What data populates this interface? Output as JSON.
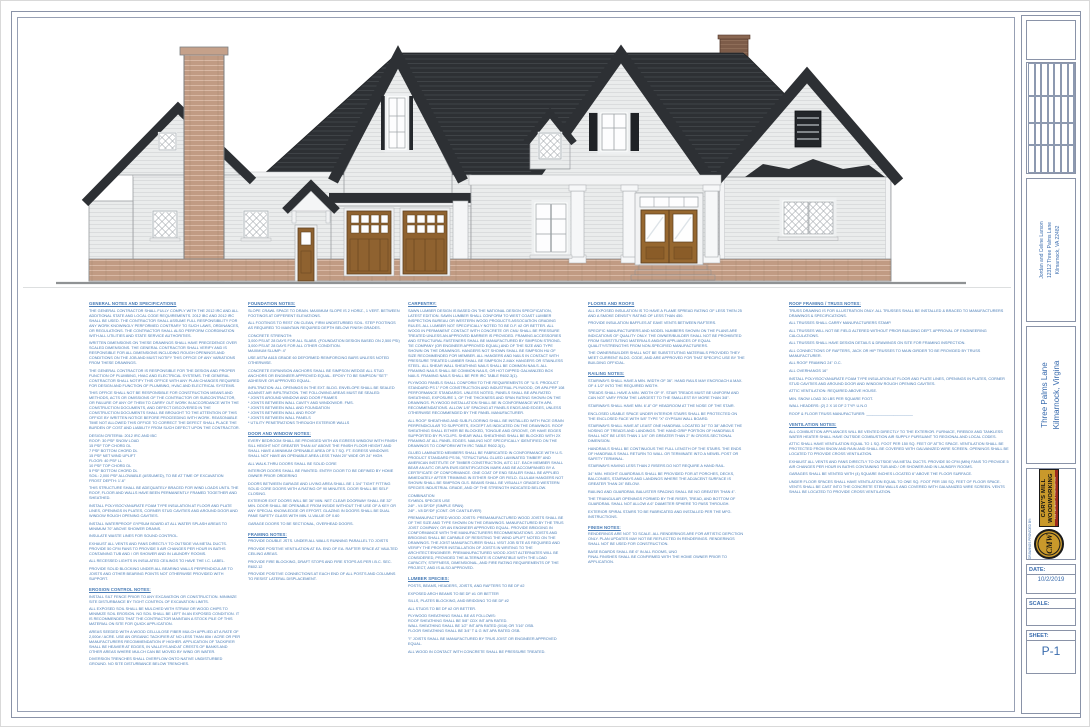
{
  "palette": {
    "note_text_blue": "#4579b4",
    "titleblock_blue": "#3a6cae",
    "roof_charcoal": "#2d3034",
    "siding_gray": "#eaecec",
    "brick_tan": "#c19b83",
    "door_wood_brown": "#8f6230",
    "logo_gold": "#c9992b",
    "logo_red": "#9e2b1e"
  },
  "titleblock": {
    "revision_table": {
      "title": "REVISION TABLE",
      "columns": [
        "NUMBER",
        "DATE",
        "REVISED BY",
        "DESCRIPTION"
      ],
      "empty_rows": 7
    },
    "owner_lines": [
      "Jordan and Celine Larson",
      "12312 Three Palms Lane",
      "Kilmarnock, VA 22482"
    ],
    "project_lines": [
      "Three Palms Lane",
      "Kilmarnock, Virgina"
    ],
    "provider_label": "DRAWINGS PROVIDED BY:",
    "logo": {
      "monogram": "CMW",
      "line1": "CARY'S MILL",
      "line2": "WOODWORKING",
      "tagline": "FINE CABINETRY & CONSTRUCTION"
    },
    "date_label": "DATE:",
    "date_value": "10/2/2019",
    "scale_label": "SCALE:",
    "scale_value": "",
    "sheet_label": "SHEET:",
    "sheet_value": "P-1"
  },
  "notes": {
    "columns": [
      {
        "sections": [
          {
            "heading": "GENERAL NOTES AND SPECIFICATIONS",
            "paragraphs": [
              "THE GENERAL CONTRACTOR SHALL FULLY COMPLY WITH THE 2012 IRC AND ALL ADDITIONAL STATE AND LOCAL CODE REQUIREMENTS. 2012 IBC AND 2012 IRC SHALL BE USED. THE CONTRACTOR SHALL ASSUME FULL RESPONSIBILITY FOR ANY WORK KNOWINGLY PERFORMED CONTRARY TO SUCH LAWS, ORDINANCES, OR REGULATIONS. THE CONTRACTOR SHALL ALSO PERFORM COORDINATION WITH ALL UTILITIES AND STATE SERVICE AUTHORITIES.",
              "WRITTEN DIMENSIONS ON THESE DRAWINGS SHALL HAVE PRECEDENCE OVER SCALED DIMENSIONS. THE GENERAL CONTRACTOR SHALL VERIFY AND IS RESPONSIBLE FOR ALL DIMENSIONS INCLUDING ROUGH OPENINGS AND CONDITIONS ON THE JOB AND MUST NOTIFY THIS OFFICE OF ANY VARIATIONS FROM THESE DRAWINGS.",
              "THE GENERAL CONTRACTOR IS RESPONSIBLE FOR THE DESIGN AND PROPER FUNCTION OF PLUMBING, HVAC AND ELECTRICAL SYSTEMS. THE GENERAL CONTRACTOR SHALL NOTIFY THIS OFFICE WITH ANY PLAN CHANGES REQUIRED FOR DESIGN AND FUNCTION OF PLUMBING, HVAC AND ELECTRICAL SYSTEMS.",
              "THIS OFFICE SHALL NOT BE RESPONSIBLE FOR CONSTRUCTION MEANS AND METHODS, ACTS OR OMISSIONS OF THE CONTRACTOR OR SUBCONTRACTOR, OR FAILURE OF ANY OF THEM TO CARRY OUT WORK IN ACCORDANCE WITH THE CONSTRUCTION DOCUMENTS, AND DEFECT DISCOVERED IN THE CONSTRUCTION DOCUMENTS SHALL BE BROUGHT TO THE ATTENTION OF THIS OFFICE BY WRITTEN NOTICE BEFORE PROCEEDING WITH WORK. REASONABLE TIME NOT ALLOWED THIS OFFICE TO CORRECT THE DEFECT SHALL PLACE THE BURDEN OF COST AND LIABILITY FROM SUCH DEFECT UPON THE CONTRACTOR.",
              "DESIGN CRITERIA:   2012 IRC AND IBC\nROOF:      30 PSF SNOW LOAD\n           15 PSF TOP CHORD DL\n           7 PSF BOTTOM CHORD DL\n           15 PSF NET WIND UPLIFT\nFLOOR:   40 PSF LL\n           10 PSF TOP CHORD DL\n           5 PSF BOTTOM CHORD DL\nSOIL:      2,000 PSF ALLOWABLE (ASSUMED), TO BE AT TIME OF EXCAVATION\nFROST DEPTH:  1'-6\"",
              "THIS STRUCTURE SHALL BE ADEQUATELY BRACED FOR WIND LOADS UNTIL THE ROOF, FLOOR AND WALLS HAVE BEEN PERMANENTLY FRAMED TOGETHER AND SHEATHED.",
              "INSTALL POLYISOCYANURATE FOAM TYPE INSULATION AT FLOOR AND PLATE LINES, OPENINGS IN PLATES, CORNER STUD CAVITIES AND AROUND DOOR AND WINDOW ROUGH OPENING CAVITIES.",
              "INSTALL WATERPROOF GYPSUM BOARD AT ALL WATER SPLASH AREAS TO MINIMUM 70\" ABOVE SHOWER DRAINS.",
              "INSULATE WASTE LINES FOR SOUND CONTROL.",
              "EXHAUST ALL VENTS AND FANS DIRECTLY TO OUTSIDE VIA METAL DUCTS. PROVIDE 50 CFM FANS TO PROVIDE 5 AIR CHANGES PER HOUR IN BATHS CONTAINING TUB AND / OR SHOWER AND IN LAUNDRY ROOMS.",
              "ALL RECESSED LIGHTS IN INSULATED CEILINGS TO HAVE THE I.C. LABEL.",
              "PROVIDE SOLID BLOCKING UNDER ALL BEARING WALLS PERPENDICULAR TO JOISTS AND OTHER BEARING POINTS NOT OTHERWISE PROVIDED WITH SUPPORT."
            ]
          },
          {
            "heading": "EROSION CONTROL NOTES:",
            "paragraphs": [
              "INSTALL SILT FENCE PRIOR TO ANY EXCAVATION OR CONSTRUCTION. MINIMIZE SITE DISTURBANCE BY TIGHT CONTROL OF EXCAVATION LIMITS.",
              "ALL EXPOSED SOIL SHALL BE MULCHED WITH STRAW OR WOOD CHIPS TO MINIMIZE SOIL EROSION. NO SOIL SHALL BE LEFT IN AN EXPOSED CONDITION. IT IS RECOMMENDED THAT THE CONTRACTOR MAINTAIN A STOCK PILE OF THIS MATERIAL ON SITE FOR QUICK APPLICATION.",
              "AREAS SEEDED WITH A WOOD CELLULOSE FIBER MULCH APPLIED AT A RATE OF 2,000# / ACRE. USE AN ORGANIC TACKIFIER AT NO LESS THAN 80# / ACRE OR PER MANUFACTURERS RECOMMENDATION IF HIGHER. APPLICATION OF TACKIFIER SHALL BE HEAVIER AT EDGES, IN VALLEYS AND AT CRESTS OF BANKS AND OTHER AREAS WHERE MULCH CAN BE MOVED BY WIND OR WATER.",
              "DIVERSION TRENCHES SHALL OVERFLOW ONTO NATIVE UNDISTURBED GROUND. NO SITE DISTURBANCE BELOW TRENCHES."
            ]
          }
        ]
      },
      {
        "sections": [
          {
            "heading": "FOUNDATION NOTES:",
            "paragraphs": [
              "SLOPE CRAWL SPACE TO DRAIN. MAXIMUM SLOPE IS 2 HORIZ., 1 VERT. BETWEEN FOOTINGS AT DIFFERENT ELEVATIONS.",
              "ALL FOOTINGS TO REST ON CLEAN, FIRM UNDISTURBED SOIL. STEP FOOTINGS AS REQUIRED TO MAINTAIN REQUIRED DEPTH BELOW FINISH GRADES.",
              "CONCRETE STRENGTH:\n3,000 PSI AT 28 DAYS FOR ALL SLABS. (FOUNDATION DESIGN BASED ON 2,500 PSI)\n3,000 PSI AT 28 DAYS FOR ALL OTHER CONDITION.\nMAXIMUM SLUMP: 4\"",
              "USE ASTM A615 GRADE 60 DEFORMED REINFORCING BARS UNLESS NOTED OTHERWISE.",
              "CONCRETE EXPANSION ANCHORS SHALL BE SIMPSON WEDGE ALL STUD ANCHORS OR ENGINEER APPROVED EQUAL. EPOXY TO BE SIMPSON \"SET\" ADHESIVE OR APPROVED EQUAL.",
              "INFILTRATION: ALL OPENINGS IN THE EXT. BLDG. ENVELOPE SHALL BE SEALED AGAINST AIR INFILTRATION. THE FOLLOWING AREAS MUST BE SEALED:\n* JOINTS AROUND WINDOW AND DOOR FRAMES\n* JOINTS BETWEEN WALL CAVITY AND WINDOW/DR. FMS.\n* JOINTS BETWEEN WALL AND FOUNDATION\n* JOINTS BETWEEN WALL AND ROOF\n* JOINTS BETWEEN WALL PANELS\n* UTILITY PENETRATIONS THROUGH EXTERIOR WALLS"
            ]
          },
          {
            "heading": "DOOR AND WINDOW NOTES:",
            "paragraphs": [
              "EVERY BEDROOM SHALL BE PROVIDED WITH AN EGRESS WINDOW WITH FINISH SILL HEIGHT NOT GREATER THAN 44\" ABOVE THE FINISH FLOOR HEIGHT AND SHALL HAVE A MINIMUM OPENABLE AREA OF 5.7 SQ. FT. EGRESS WINDOWS SHALL NOT HAVE AN OPENABLE AREA LESS THAN 20\" WIDE OR 24\" HIGH.",
              "ALL WALK-THRU DOORS SHALL BE SOLID CORE",
              "INTERIOR DOORS SHALL BE PAINTED.  ENTRY DOOR TO BE DEFINED BY HOME OWNER PRIOR ORDERING",
              "DOORS BETWEEN GARAGE AND LIVING AREA SHALL BE 1 3/4\" TIGHT FITTING SOLID CORE DOORS WITH A RATING OF 90 MINUTES. DOOR SHALL BE SELF CLOSING.",
              "EXTERIOR EXIT DOORS WILL BE 36\" MIN. NET CLEAR DOORWAY SHALL BE 32\" MIN. DOOR SHALL BE OPENABLE FROM INSIDE WITHOUT THE USE OF A KEY OR ANY SPECIAL KNOWLEDGE OR EFFORT. GLAZING IN DOORS SHALL BE DUAL PANE SAFETY GLASS WITH MIN. U-VALUE OF 0.60",
              "GARAGE DOORS TO BE SECTIONAL, OVERHEAD DOORS."
            ]
          },
          {
            "heading": "FRAMING NOTES:",
            "paragraphs": [
              "PROVIDE DOUBLE JSTS. UNDER ALL WALLS RUNNING PARALLEL TO JOISTS",
              "PROVIDE POSITIVE VENTILATION AT EA. END OF EA. RAFTER SPACE AT VAULTED CEILING AREAS.",
              "PROVIDE FIRE BLOCKING, DRAFT STOPS AND FIRE STOPS AS PER I.B.C. SEC. R602.12",
              "PROVIDE POSITIVE CONNECTIONS AT EACH END OF ALL POSTS AND COLUMNS TO RESIST LATERAL DISPLACEMENT."
            ]
          }
        ]
      },
      {
        "sections": [
          {
            "heading": "CARPENTRY:",
            "paragraphs": [
              "SAWN LUMBER DESIGN IS BASED ON THE NATIONAL DESIGN SPECIFICATION, LATEST EDITION. SAWN LUMBER SHALL CONFORM TO WEST COAST LUMBER INSPECTION BUREAU OR WESTERN WOOD PRODUCTS ASSOCIATION GRADING RULES. ALL LUMBER NOT SPECIFICALLY NOTED TO BE D.F. #2 OR BETTER. ALL WOOD IN PERMANENT CONTACT WITH CONCRETE OR CMU SHALL BE PRESSURE TREATED UNLESS AN APPROVED BARRIER IS PROVIDED. FRAMING ACCESSORIES AND STRUCTURAL FASTENERS SHALL BE MANUFACTURED BY SIMPSON STRONG-TIE COMPANY (OR ENGINEER APPROVED EQUAL) AND OF THE SIZE AND TYPE SHOWN ON THE DRAWINGS. HANGERS NOT SHOWN SHALL BE SIMPSON HU OF SIZE RECOMMENDED FOR MEMBER. ALL HANGERS AND NAILS IN CONTACT WITH PRESSURE TREATED LUMBER SHALL BE SIMPSON Z-MAX HANGERS OR STAINLESS STEEL. ALL SHEAR WALL SHEATHING NAILS SHALL BE COMMON NAILS. ALL FRAMING NAILS SHALL BE COMMON NAILS, OR HOT DIPPED GALVANIZED BOX NAILS. FRAMING NAILS SHALL BE PER IRC TABLE R602.3(1).",
              "PLYWOOD PANELS SHALL CONFORM TO THE REQUIREMENTS OF \"U.S. PRODUCT STANDARD PS 1\" FOR CONSTRUCTION AND INDUSTRIAL PLYWOOD, OR APA PRP 108 PERFORMANCE STANDARDS. UNLESS NOTED, PANELS SHALL BE APA RATED SHEATHING, EXPOSURE 1, OF THE THICKNESS AND SPAN RATING SHOWN ON THE DRAWINGS. PLYWOOD INSTALLATION SHALL BE IN CONFORMANCE WITH APA RECOMMENDATIONS. ALLOW 1/8\" SPACING AT PANELS ENDS AND EDGES, UNLESS OTHERWISE RECOMMENDED BY THE PANEL MANUFACTURER.",
              "ALL ROOF SHEATHING AND SUB-FLOORING SHALL BE INSTALLED WITH FACE GRAIN PERPENDICULAR TO SUPPORTS, EXCEPT AS INDICATED ON THE DRAWINGS. ROOF SHEATHING SHALL EITHER BE BLOCKED, TONGUE AND GROOVE, OR HAVE EDGES SUPPORTED BY PLYCLIPS. SHEAR WALL SHEATHING SHALL BE BLOCKED WITH 2X FRAMING AT ALL PANEL EDGES. NAILING NOT SPECIFICALLY IDENTIFIED ON THE DRAWINGS TO CONFORM WITH IRC TABLE R602.3(1).",
              "GLUED LAMINATED MEMBERS SHALL BE FABRICATED IN CONFORMANCE WITH U.S. PRODUCT STANDARD PS 56, \"STRUCTURAL GLUED LAMINATED TIMBER\" AND AMERICAN INSTITUTE OF TIMBER CONSTRUCTION, AITC 117. EACH MEMBER SHALL BEAR AN AITC OR APA EWS IDENTIFICATION MARK AND BE ACCOMPANIED BY A CERTIFICATE OF CONFORMANCE. ONE COAT OF END SEALER SHALL BE APPLIED IMMEDIATELY AFTER TRIMMING IN EITHER SHOP OR FIELD. GLULAM HANGERS NOT SHOWN SHALL BE SIMPSON GLS. BEAMS SHALL BE VISUALLY GRADED WESTERN SPECIES INDUSTRIAL GRADE, AND OF THE STRENGTH INDICATED BELOW.",
              "            COMBINATION\nSYMBOL              SPECIES          USE\n24F - V4             DF/DF              (SIMPLE SPAN)\n24F - V8             DF/DF              (CONT. OR CANTILEVER)",
              "PREMANUFACTURED WOOD JOISTS: PREMANUFACTURED WOOD JOISTS SHALL BE OF THE SIZE AND TYPE SHOWN ON THE DRAWINGS. MANUFACTURED BY THE TRUS JOIST COMPANY, OR AN ENGINEER APPROVED EQUAL. PROVIDE BRIDGING IN CONFORMANCE WITH THE MANUFACTURERS RECOMMENDATIONS. JOISTS AND BRIDGING SHALL BE CAPABLE OF RESISTING THE WIND UPLIFT NOTED ON THE DRAWINGS. THE JOIST MANUFACTURER SHALL VISIT JOB SITE AS REQUIRED AND VERIFY THE PROPER INSTALLATION OF JOISTS IN WRITING TO THE ARCHITECT/ENGINEER. PREMANUFACTURED WOOD JOIST ALTERNATES WILL BE CONSIDERED, PROVIDED THE ALTERNATE IS COMPATIBLE WITH THE LOAD CAPACITY, STIFFNESS, DIMENSIONAL, AND FIRE RATING REQUIREMENTS OF THE PROJECT, AND IS ALSO APPROVED."
            ]
          },
          {
            "heading": "LUMBER SPECIES:",
            "paragraphs": [
              "POSTS, BEAMS, HEADERS, JOISTS, AND RAFTERS TO BE DF #2",
              "EXPOSED ARCH BEAMS TO BE DF #1 OR BETTER",
              "SILLS, PLATES BLOCKING, AND BRIDGING TO BE DF #2",
              "ALL STUDS TO BE DF #2 OR BETTER.",
              "PLYWOOD SHEATHING SHALL BE AS FOLLOWS:\n   ROOF SHEATHING SHALL BE 5/8\" CDX INT APA RATED.\n   WALL SHEATHING SHALL BE 1/2\" INT APA RATED (0/16) OR 7/16\" OSB.\n   FLOOR SHEATHING SHALL BE 3/4\" T & G INT APA RATED OSB.",
              "\"I\" JOISTS SHALL BE MANUFACTURED BY TRUS JOIST OR ENGINEER APPROVED EQUAL.",
              "ALL WOOD IN CONTACT WITH CONCRETE SHALL BE PRESSURE TREATED."
            ]
          }
        ]
      },
      {
        "sections": [
          {
            "heading": "FLOORS AND ROOFS",
            "paragraphs": [
              "ALL EXPOSED INSULATION IS TO HAVE A FLAME SPREAD RATING OF LESS THEN 25 AND A SMOKE DENSITY RATING OF LESS THAN 450.",
              "PROVIDE INSULATION BAFFLES AT EAVE VENTS BETWEEN RAFTERS.",
              "SPECIFIC MANUFACTURERS AND MODEL NUMBERS SHOWN ON THE PLANS ARE INDICATIONS OF QUALITY ONLY. THE OWNER/BUILDER SHALL NOT BE PROHIBITED FROM SUBSTITUTING MATERIALS AND/OR APPLIANCES OF EQUAL QUALITY/STRENGTHS FROM NON-SPECIFIED MANUFACTURERS.",
              "THE OWNER/BUILDER SHALL NOT BE SUBSTITUTING MATERIALS PROVIDED THEY MEET CURRENT BLDG. CODE, AND ARE APPROVED FOR THAT SPECIFIC USE BY THE BUILDING OFFICIAL."
            ]
          },
          {
            "heading": "RAILING NOTES:",
            "paragraphs": [
              "STAIRWAYS SHALL HAVE A MIN. WIDTH OF 36\". HAND RAILS MAY ENCROACH A MAX. OF 4 1/2\" INTO THE REQUIRED WIDTH.",
              "TREADS SHALL HAVE A MIN. WIDTH OF 9\". STAIR TREADS MUST BE UNIFORM AND CAN NOT VARY FROM THE LARGEST TO THE SMALLEST BY MORE THAN 3/8\".",
              "STAIRWAYS SHALL HAVE MIN. 6'-8\" OF HEADROOM AT THE NOSE OF THE STAIR.",
              "ENCLOSED USABLE SPACE UNDER INTERIOR STAIRS SHALL BE PROTECTED ON THE ENCLOSED FACE WITH 5/8\" TYPE \"X\" GYPSUM WALL BOARD.",
              "STAIRWAYS SHALL HAVE AT LEAST ONE HANDRAIL LOCATED 34\" TO 38\" ABOVE THE NOSING OF TREADS AND LANDINGS. THE HAND GRIP PORTION OF HANDRAILS SHALL NOT BE LESS THAN 1 1/4\" OR GREATER THAN 2\" IN CROSS-SECTIONAL DIMENSION.",
              "HANDRAILS SHALL BE CONTINUOUS THE FULL LENGTH OF THE STAIRS. THE ENDS OF HANDRAILS SHALL RETURN TO WALL OR TERMINATE INTO A NEWEL POST OR SAFETY TERMINAL.",
              "STAIRWAYS HAVING LESS THAN 2 RISERS DO NOT REQUIRE A HAND RAIL.",
              "34\" MIN. HEIGHT GUARDRAILS SHALL BE PROVIDED FOR AT PORCHES, DECKS, BALCONIES, STAIRWAYS AND LANDINGS WHERE THE ADJACENT SURFACE IS GREATER THAN 24\" BELOW.",
              "RAILING AND GUARDRAIL BALUSTER SPACING SHALL BE NO GREATER THAN 4\".",
              "THE TRIANGULAR OPENINGS FORMED BY THE RISER, TREAD, AND BOTTOM OF GUARDRAIL SHALL NOT ALLOW A 6\" DIAMETER SPHERE TO PASS THROUGH.",
              "EXTERIOR SPIRAL STAIRS TO BE FABRICATED AND INSTALLED PER THE MFG. INSTRUCTIONS."
            ]
          },
          {
            "heading": "FINISH NOTES:",
            "paragraphs": [
              "RENDERINGS ARE NOT TO SCALE. ALL RENDERINGS ARE FOR ARTISTIC DEPICTION ONLY. PLAN UPDATES MAY NOT BE REFLECTED IN RENDERINGS. RENDERINGS SHALL NOT BE USED FOR CONSTRUCTION.",
              "BASE BOARDS SHALL BE 6\" IN ALL ROOMS, UNO\nFINAL FINISHES SHALL BE CONFIRMED WITH THE HOME OWNER PRIOR TO APPLICATION."
            ]
          }
        ]
      },
      {
        "sections": [
          {
            "heading": "ROOF FRAMING / TRUSS NOTES:",
            "paragraphs": [
              "TRUSS DRAWING IS FOR ILLUSTRATION ONLY. ALL TRUSSES SHALL BE INSTALLED & BRACED TO MANUFACTURERS DRAWINGS & SPECIFICATIONS.",
              "ALL TRUSSES SHALL CARRY MANUFACTURERS STAMP.",
              "ALL TRUSSES WILL NOT BE FIELD ALTERED WITHOUT PRIOR BUILDING DEPT. APPROVAL OF ENGINEERING CALCULATIONS.",
              "ALL TRUSSES SHALL HAVE DESIGN DETAILS & DRAWINGS ON SITE FOR FRAMING INSPECTION.",
              "ALL CONNECTIONS OF RAFTERS, JACK OR HIP TRUSSES TO MAIN GIRDER TO BE PROVIDED BY TRUSS MANUFACTURER.",
              "ALL ROOF FRAMING 24\" O.C.",
              "ALL OVERHANGS 16\"",
              "INSTALL POLYISOCYANURATE FOAM TYPE INSULATION AT FLOOR AND PLATE LINES, OPENINGS IN PLATES, CORNER STUD CAVITIES AND AROUND DOOR AND WINDOW ROUGH OPENING CAVITIES.",
              "ATTIC VENTILATION: REQUIRED ABOVE HOUSE.",
              "MIN. SNOW LOAD 30 LBS PER SQUARE FOOT.",
              "WALL HEADERS: (2) 2 X 10 DF 2 TYP. U.N.O",
              "ROOF & FLOOR TRUSS MANUFACTURER: ______________________"
            ]
          },
          {
            "heading": "VENTILATION NOTES:",
            "paragraphs": [
              "ALL COMBUSTION APPLIANCES WILL BE VENTED DIRECTLY TO THE EXTERIOR. FURNACE, FIREBOX AND TANKLESS WATER HEATER SHALL HAVE OUTSIDE COMBUSTION AIR SUPPLY PURSUANT TO REGIONAL AND LOCAL CODES.",
              "ATTIC SHALL HAVE VENTILATION EQUAL TO 1 SQ. FOOT PER 150 SQ. FEET OF ATTIC SPACE. VENTILATION SHALL BE PROTECTED FROM SNOW AND RAIN AND SHALL BE COVERED WITH GALVANIZED WIRE SCREEN. OPENINGS SHALL BE LOCATED TO PROVIDE CROSS VENTILATION.",
              "EXHAUST ALL VENTS AND FANS DIRECTLY TO OUTSIDE VIA METAL DUCTS. PROVIDE 50 CFM (MIN) FANS TO PROVIDE 5 AIR CHANGES PER HOUR IN BATHS CONTAINING TUB AND / OR SHOWER AND IN LAUNDRY ROOMS.",
              "GARAGES SHALL BE VENTED WITH (4) SQUARE INCHES LOCATED 6\" ABOVE THE FLOOR SURFACE.",
              "UNDER FLOOR SPACES SHALL HAVE VENTILATION EQUAL TO ONE SQ. FOOT PER 150 SQ. FEET OF FLOOR SPACE. VENTS SHALL BE CAST INTO THE CONCRETE STEM WALLS AND COVERED WITH GALVANIZED WIRE SCREEN. VENTS SHALL BE LOCATED TO PROVIDE CROSS VENTILATION."
            ]
          }
        ]
      }
    ]
  }
}
